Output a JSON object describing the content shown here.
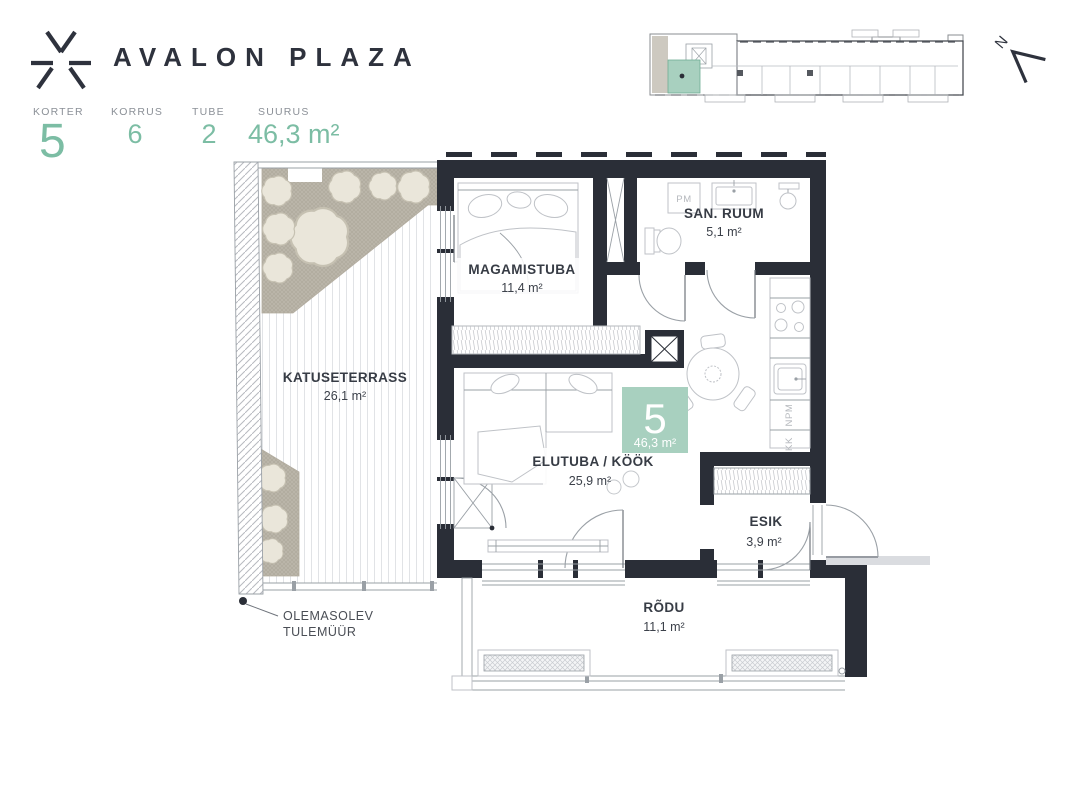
{
  "header": {
    "brand": "AVALON PLAZA",
    "info": [
      {
        "label": "KORTER",
        "value": "5"
      },
      {
        "label": "KORRUS",
        "value": "6"
      },
      {
        "label": "TUBE",
        "value": "2"
      },
      {
        "label": "SUURUS",
        "value": "46,3 m²"
      }
    ]
  },
  "north": {
    "label": "N"
  },
  "badge": {
    "number": "5",
    "area": "46,3 m²"
  },
  "rooms": {
    "terrace": {
      "name": "KATUSETERRASS",
      "area": "26,1 m²"
    },
    "bedroom": {
      "name": "MAGAMISTUBA",
      "area": "11,4 m²"
    },
    "bathroom": {
      "name": "SAN. RUUM",
      "area": "5,1 m²"
    },
    "living": {
      "name": "ELUTUBA / KÖÖK",
      "area": "25,9 m²"
    },
    "hall": {
      "name": "ESIK",
      "area": "3,9 m²"
    },
    "balcony": {
      "name": "RÕDU",
      "area": "11,1 m²"
    }
  },
  "appliances": {
    "washing_machine": "PM",
    "dishwasher": "NPM",
    "fridge": "KK"
  },
  "note": {
    "line1": "OLEMASOLEV",
    "line2": "TULEMÜÜR"
  },
  "colors": {
    "accent_green": "#7cbda4",
    "badge_green": "#a8d0bf",
    "wall_dark": "#2a2e37"
  }
}
